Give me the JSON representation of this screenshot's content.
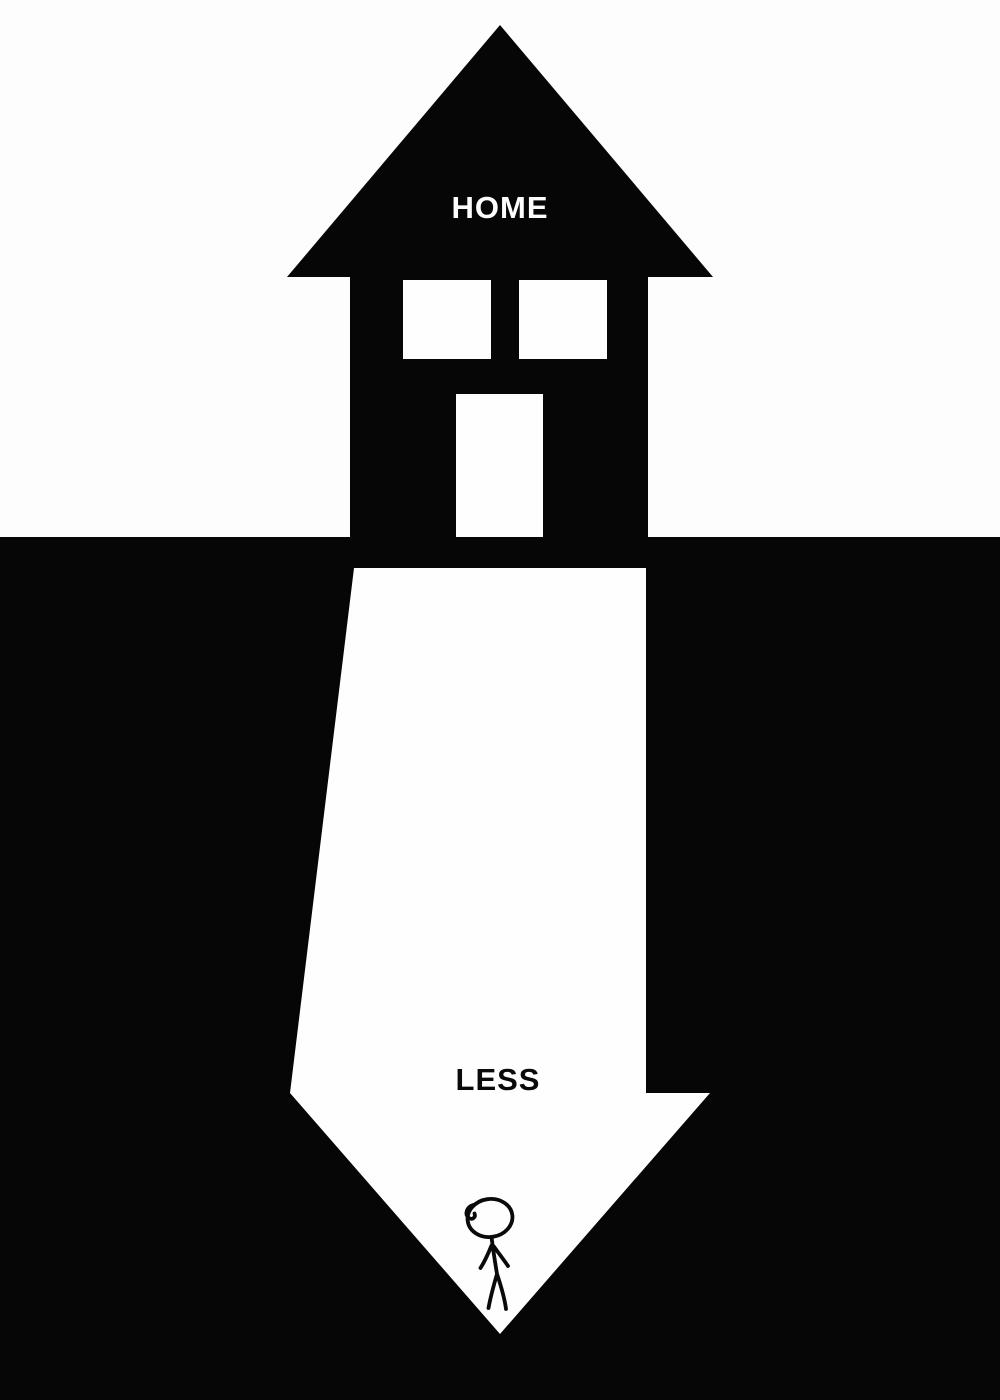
{
  "poster": {
    "home_label": "HOME",
    "less_label": "LESS",
    "colors": {
      "ink_black": "#060606",
      "paper_white": "#fdfdfd"
    },
    "icons": {
      "house": "house-up-arrow-icon",
      "arrow": "down-arrow-icon",
      "person": "stick-figure-icon"
    }
  }
}
